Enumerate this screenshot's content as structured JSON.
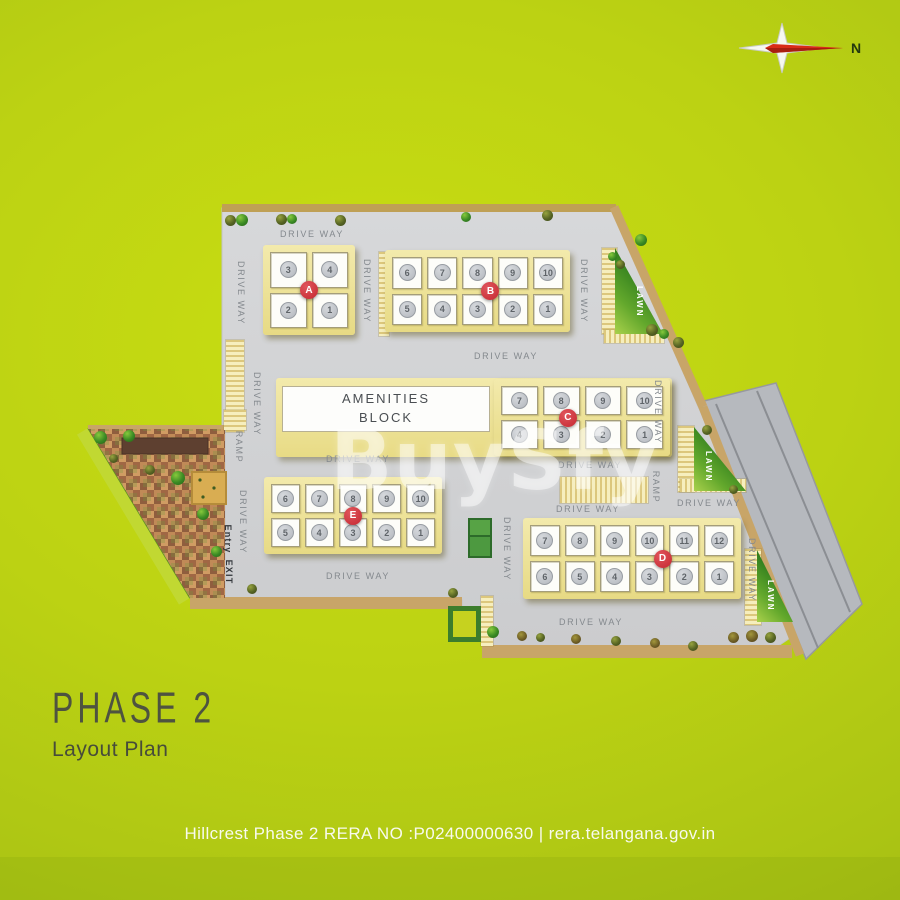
{
  "title": {
    "heading": "PHASE 2",
    "subheading": "Layout Plan"
  },
  "footer": {
    "text": "Hillcrest Phase 2 RERA NO :P02400000630 | rera.telangana.gov.in"
  },
  "compass": {
    "label": "N"
  },
  "watermark": {
    "text": "BuySfy"
  },
  "amenities": {
    "line1": "AMENITIES",
    "line2": "BLOCK"
  },
  "colors": {
    "background_green": "#bcd213",
    "site_gray": "#d2d3d5",
    "building_cream": "#efe493",
    "badge_red": "#c9303a",
    "lawn_dark": "#2f7d1d",
    "lawn_light": "#a9d14c",
    "path_tan": "#c8a568",
    "road_gray": "#b6b9be"
  },
  "blocks": [
    {
      "name": "A",
      "x": 263,
      "y": 245,
      "w": 92,
      "h": 90,
      "cols": 2,
      "top": [
        "3",
        "4"
      ],
      "bottom": [
        "2",
        "1"
      ],
      "badge_x": 0.5
    },
    {
      "name": "B",
      "x": 385,
      "y": 250,
      "w": 185,
      "h": 82,
      "cols": 5,
      "top": [
        "6",
        "7",
        "8",
        "9",
        "10"
      ],
      "bottom": [
        "5",
        "4",
        "3",
        "2",
        "1"
      ],
      "badge_x": 0.57
    },
    {
      "name": "C",
      "x": 494,
      "y": 379,
      "w": 176,
      "h": 77,
      "cols": 4,
      "top": [
        "7",
        "8",
        "9",
        "10"
      ],
      "bottom": [
        "4",
        "3",
        "2",
        "1"
      ],
      "badge_x": 0.42
    },
    {
      "name": "E",
      "x": 264,
      "y": 477,
      "w": 178,
      "h": 77,
      "cols": 5,
      "top": [
        "6",
        "7",
        "8",
        "9",
        "10"
      ],
      "bottom": [
        "5",
        "4",
        "3",
        "2",
        "1"
      ],
      "badge_x": 0.5
    },
    {
      "name": "D",
      "x": 523,
      "y": 518,
      "w": 218,
      "h": 81,
      "cols": 6,
      "top": [
        "7",
        "8",
        "9",
        "10",
        "11",
        "12"
      ],
      "bottom": [
        "6",
        "5",
        "4",
        "3",
        "2",
        "1"
      ],
      "badge_x": 0.64
    }
  ],
  "lawns": [
    {
      "label": "LAWN",
      "x": 615,
      "y": 248,
      "w": 48,
      "h": 86,
      "lx": 20,
      "ly": 38
    },
    {
      "label": "LAWN",
      "x": 694,
      "y": 427,
      "w": 52,
      "h": 64,
      "lx": 10,
      "ly": 24
    },
    {
      "label": "LAWN",
      "x": 757,
      "y": 550,
      "w": 36,
      "h": 72,
      "lx": 9,
      "ly": 30
    }
  ],
  "road_labels": [
    {
      "t": "DRIVE WAY",
      "x": 312,
      "y": 234
    },
    {
      "t": "DRIVE WAY",
      "x": 241,
      "y": 293,
      "v": 1
    },
    {
      "t": "DRIVE WAY",
      "x": 367,
      "y": 291,
      "v": 1
    },
    {
      "t": "DRIVE WAY",
      "x": 584,
      "y": 291,
      "v": 1
    },
    {
      "t": "DRIVE WAY",
      "x": 506,
      "y": 356
    },
    {
      "t": "DRIVE WAY",
      "x": 257,
      "y": 404,
      "v": 1
    },
    {
      "t": "RAMP",
      "x": 239,
      "y": 447,
      "v": 1
    },
    {
      "t": "DRIVE WAY",
      "x": 243,
      "y": 522,
      "v": 1
    },
    {
      "t": "Entry",
      "x": 228,
      "y": 539,
      "v": 1,
      "dark": 1
    },
    {
      "t": "EXIT",
      "x": 229,
      "y": 572,
      "v": 1,
      "dark": 1
    },
    {
      "t": "DRIVE WAY",
      "x": 358,
      "y": 459
    },
    {
      "t": "DRIVE WAY",
      "x": 590,
      "y": 465
    },
    {
      "t": "DRIVE WAY",
      "x": 658,
      "y": 412,
      "v": 1
    },
    {
      "t": "RAMP",
      "x": 656,
      "y": 487,
      "v": 1
    },
    {
      "t": "DRIVE WAY",
      "x": 588,
      "y": 509
    },
    {
      "t": "DRIVE WAY",
      "x": 709,
      "y": 503
    },
    {
      "t": "DRIVE WAY",
      "x": 507,
      "y": 549,
      "v": 1
    },
    {
      "t": "DRIVE WAY",
      "x": 358,
      "y": 576
    },
    {
      "t": "DRIVE WAY",
      "x": 752,
      "y": 570,
      "v": 1
    },
    {
      "t": "DRIVE WAY",
      "x": 591,
      "y": 622
    }
  ]
}
